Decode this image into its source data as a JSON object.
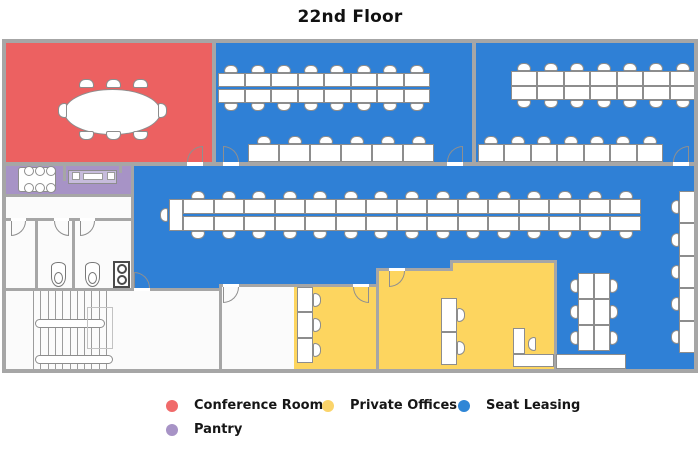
{
  "title": "22nd Floor",
  "legend": {
    "items": [
      {
        "label": "Conference Room",
        "color": "#F06A6A"
      },
      {
        "label": "Private Offices",
        "color": "#FBD46A"
      },
      {
        "label": "Seat Leasing",
        "color": "#2F86D6"
      },
      {
        "label": "Pantry",
        "color": "#A793C6"
      }
    ]
  },
  "colors": {
    "red": "#EC6161",
    "blue": "#2F80D6",
    "yellow": "#FDD55F",
    "purple": "#A793C6",
    "wall": "#A6A6A6"
  },
  "floorplan": {
    "rooms": [
      {
        "name": "conference-room",
        "color": "red",
        "rects": [
          [
            0,
            0,
            208,
            121
          ]
        ]
      },
      {
        "name": "seat-leasing-a",
        "color": "blue",
        "rects": [
          [
            210,
            0,
            256,
            121
          ]
        ]
      },
      {
        "name": "seat-leasing-b",
        "color": "blue",
        "rects": [
          [
            470,
            0,
            220,
            121
          ]
        ]
      },
      {
        "name": "pantry",
        "color": "purple",
        "rects": [
          [
            0,
            121,
            125,
            32
          ]
        ]
      },
      {
        "name": "seat-leasing-main",
        "color": "blue",
        "rects": [
          [
            125,
            121,
            565,
            96
          ],
          [
            125,
            217,
            319,
            8
          ],
          [
            125,
            225,
            245,
            16
          ],
          [
            125,
            241,
            91,
            5
          ],
          [
            548,
            217,
            142,
            112
          ]
        ]
      },
      {
        "name": "private-office-1",
        "color": "yellow",
        "rects": [
          [
            288,
            241,
            85,
            88
          ]
        ]
      },
      {
        "name": "private-office-2",
        "color": "yellow",
        "rects": [
          [
            444,
            217,
            104,
            8
          ],
          [
            373,
            225,
            175,
            104
          ]
        ]
      }
    ],
    "walls": [
      [
        0,
        119,
        690,
        4
      ],
      [
        206,
        0,
        4,
        119
      ],
      [
        466,
        0,
        4,
        119
      ],
      [
        0,
        151,
        125,
        3
      ],
      [
        57,
        121,
        3,
        17
      ],
      [
        113,
        121,
        3,
        9
      ],
      [
        125,
        123,
        3,
        125
      ],
      [
        0,
        175,
        128,
        3
      ],
      [
        29,
        178,
        3,
        67
      ],
      [
        66,
        178,
        3,
        67
      ],
      [
        0,
        245,
        216,
        3
      ],
      [
        213,
        241,
        3,
        88
      ],
      [
        213,
        241,
        160,
        3
      ],
      [
        370,
        225,
        3,
        104
      ],
      [
        370,
        225,
        77,
        3
      ],
      [
        444,
        217,
        3,
        11
      ],
      [
        444,
        217,
        107,
        3
      ],
      [
        548,
        217,
        3,
        112
      ]
    ],
    "doors": [
      {
        "arc": [
          181,
          103,
          16,
          16
        ],
        "dir": "tl",
        "thr": [
          181,
          119,
          16,
          4
        ]
      },
      {
        "arc": [
          217,
          103,
          16,
          16
        ],
        "dir": "tr",
        "thr": [
          217,
          119,
          16,
          4
        ]
      },
      {
        "arc": [
          441,
          103,
          16,
          16
        ],
        "dir": "tl",
        "thr": [
          441,
          119,
          16,
          4
        ]
      },
      {
        "arc": [
          667,
          103,
          16,
          16
        ],
        "dir": "tl",
        "thr": [
          667,
          119,
          16,
          4
        ]
      },
      {
        "arc": [
          128,
          229,
          16,
          16
        ],
        "dir": "tr",
        "thr": [
          128,
          245,
          16,
          3
        ]
      },
      {
        "arc": [
          217,
          244,
          16,
          16
        ],
        "dir": "br",
        "thr": [
          217,
          241,
          16,
          3
        ]
      },
      {
        "arc": [
          347,
          244,
          16,
          16
        ],
        "dir": "bl",
        "thr": [
          347,
          241,
          16,
          3
        ]
      },
      {
        "arc": [
          383,
          228,
          16,
          16
        ],
        "dir": "br",
        "thr": [
          383,
          225,
          16,
          3
        ]
      },
      {
        "arc": [
          5,
          178,
          15,
          15
        ],
        "dir": "br",
        "thr": [
          5,
          175,
          15,
          3
        ]
      },
      {
        "arc": [
          48,
          178,
          15,
          15
        ],
        "dir": "bl",
        "thr": [
          48,
          175,
          15,
          3
        ]
      },
      {
        "arc": [
          74,
          178,
          15,
          15
        ],
        "dir": "br",
        "thr": [
          74,
          175,
          15,
          3
        ]
      }
    ],
    "furniture": [
      {
        "kind": "desks",
        "name": "desk-row-a-top",
        "x": 212,
        "y": 30,
        "w": 212,
        "h": 30,
        "cols": 8,
        "rows": 2,
        "gap": 2,
        "chairs": "tb"
      },
      {
        "kind": "desks",
        "name": "desk-row-a-bottom",
        "x": 242,
        "y": 101,
        "w": 186,
        "h": 18,
        "cols": 6,
        "rows": 1,
        "gap": 0,
        "chairs": "t"
      },
      {
        "kind": "desks",
        "name": "desk-row-b-top",
        "x": 505,
        "y": 28,
        "w": 185,
        "h": 29,
        "cols": 7,
        "rows": 2,
        "gap": 0,
        "chairs": "tb"
      },
      {
        "kind": "desks",
        "name": "desk-row-b-bottom",
        "x": 472,
        "y": 101,
        "w": 185,
        "h": 18,
        "cols": 7,
        "rows": 1,
        "gap": 0,
        "chairs": "t"
      },
      {
        "kind": "desks",
        "name": "desk-row-central",
        "x": 177,
        "y": 156,
        "w": 458,
        "h": 32,
        "cols": 15,
        "rows": 2,
        "gap": 2,
        "chairs": "tb"
      },
      {
        "kind": "desks",
        "name": "desk-endcap",
        "x": 163,
        "y": 156,
        "w": 14,
        "h": 32,
        "cols": 1,
        "rows": 1,
        "gap": 0,
        "chairs": ""
      },
      {
        "kind": "chair",
        "x": 154,
        "y": 165,
        "o": "w"
      },
      {
        "kind": "desks",
        "name": "desk-col-right-wall",
        "x": 673,
        "y": 148,
        "w": 17,
        "h": 162,
        "cols": 1,
        "rows": 5,
        "gap": 0,
        "chairs": "w"
      },
      {
        "kind": "desks",
        "name": "desk-cluster-south",
        "x": 572,
        "y": 230,
        "w": 32,
        "h": 78,
        "cols": 2,
        "rows": 3,
        "gap": 0,
        "chairs": "we"
      },
      {
        "kind": "desks",
        "name": "desk-col-office-1",
        "x": 291,
        "y": 244,
        "w": 16,
        "h": 76,
        "cols": 1,
        "rows": 3,
        "gap": 0,
        "chairs": "e"
      },
      {
        "kind": "desks",
        "name": "desk-col-office-2",
        "x": 435,
        "y": 255,
        "w": 16,
        "h": 67,
        "cols": 1,
        "rows": 2,
        "gap": 0,
        "chairs": "e"
      },
      {
        "kind": "rect",
        "name": "l-desk-vertical",
        "x": 507,
        "y": 285,
        "w": 12,
        "h": 26
      },
      {
        "kind": "rect",
        "name": "l-desk-base",
        "x": 507,
        "y": 311,
        "w": 41,
        "h": 13
      },
      {
        "kind": "chair",
        "x": 522,
        "y": 294,
        "o": "w"
      },
      {
        "kind": "rect",
        "name": "shelf",
        "x": 550,
        "y": 311,
        "w": 70,
        "h": 15
      },
      {
        "kind": "table-oval",
        "name": "conference-table",
        "x": 58,
        "y": 46,
        "w": 97,
        "h": 46,
        "chairs": [
          [
            73,
            36,
            "n"
          ],
          [
            100,
            36,
            "n"
          ],
          [
            127,
            36,
            "n"
          ],
          [
            73,
            88,
            "s"
          ],
          [
            100,
            88,
            "s"
          ],
          [
            127,
            88,
            "s"
          ],
          [
            52,
            60,
            "w"
          ],
          [
            152,
            60,
            "e"
          ]
        ]
      },
      {
        "kind": "table",
        "name": "pantry-table",
        "x": 12,
        "y": 124,
        "w": 38,
        "h": 25,
        "chairs": [
          [
            18,
            123,
            "c"
          ],
          [
            29,
            123,
            "c"
          ],
          [
            40,
            123,
            "c"
          ],
          [
            18,
            140,
            "c"
          ],
          [
            29,
            140,
            "c"
          ],
          [
            40,
            140,
            "c"
          ]
        ]
      },
      {
        "kind": "counter",
        "name": "pantry-counter",
        "x": 62,
        "y": 127,
        "w": 49,
        "h": 14,
        "items": [
          [
            66,
            129,
            8,
            8
          ],
          [
            77,
            130,
            20,
            7
          ],
          [
            101,
            129,
            8,
            8
          ]
        ]
      },
      {
        "kind": "stairs",
        "name": "stairwell",
        "x": 27,
        "y": 248,
        "w": 78,
        "h": 78
      },
      {
        "kind": "toilet",
        "x": 45,
        "y": 219
      },
      {
        "kind": "toilet",
        "x": 79,
        "y": 219
      },
      {
        "kind": "appliance",
        "x": 107,
        "y": 218
      }
    ]
  }
}
